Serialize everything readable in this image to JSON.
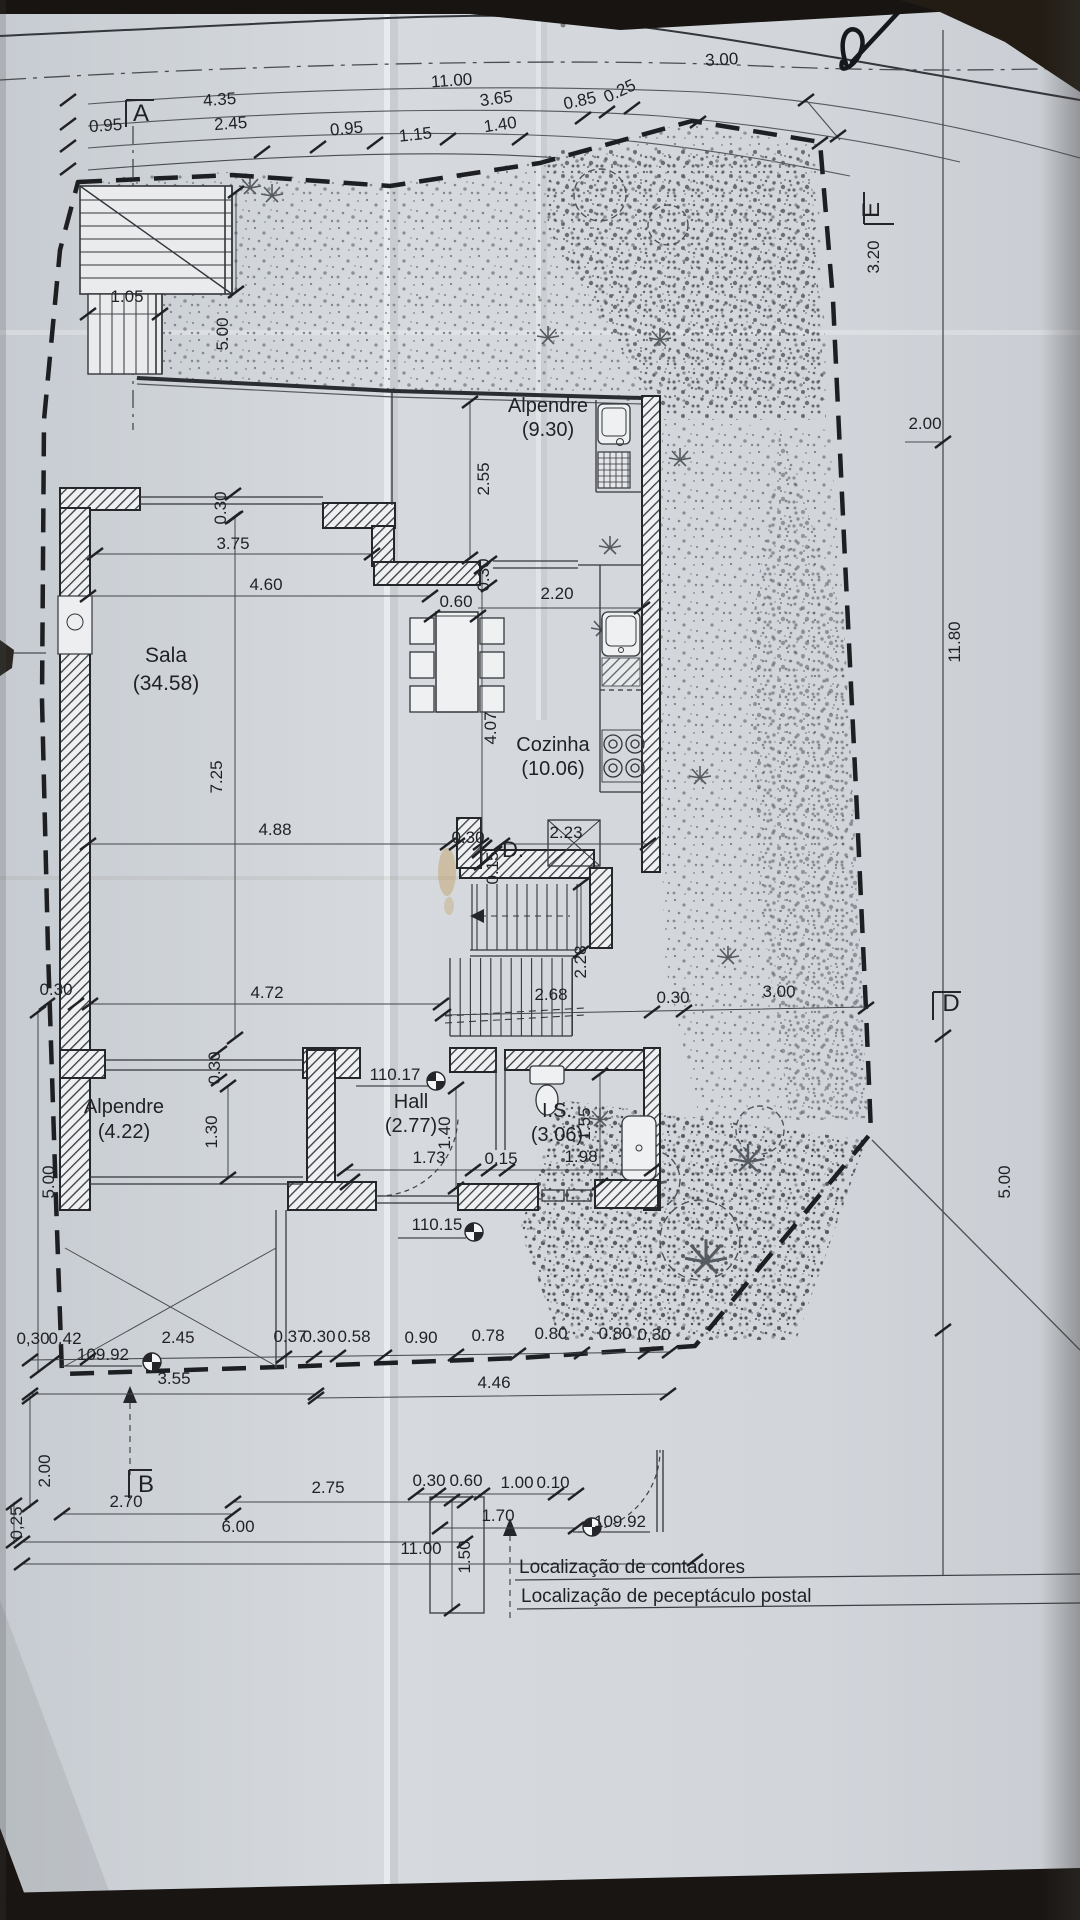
{
  "drawing": {
    "kind": "architectural ground floor plan (photographed blueprint)",
    "language": "pt",
    "paper_color": "#d2d6db",
    "ink_color": "#1f2125"
  },
  "rooms": [
    {
      "name": "Sala",
      "area": "(34.58)"
    },
    {
      "name": "Cozinha",
      "area": "(10.06)"
    },
    {
      "name": "Alpendre",
      "area": "(9.30)"
    },
    {
      "name": "Alpendre",
      "area": "(4.22)"
    },
    {
      "name": "Hall",
      "area": "(2.77)"
    },
    {
      "name": "I.S.",
      "area": "(3.06)"
    }
  ],
  "levels": [
    "110.17",
    "110.15",
    "109.92",
    "109.92"
  ],
  "section_markers": [
    "A",
    "B",
    "D",
    "D.",
    "E"
  ],
  "notes": {
    "contadores": "Localização de contadores",
    "postal": "Localização de peceptáculo postal"
  },
  "annotations": [
    {
      "t": "11.00",
      "x": 452,
      "y": 86,
      "r": -4
    },
    {
      "t": "4.35",
      "x": 220,
      "y": 105,
      "r": -4
    },
    {
      "t": "3.65",
      "x": 497,
      "y": 104,
      "r": -8
    },
    {
      "t": "3.00",
      "x": 722,
      "y": 65,
      "r": -3
    },
    {
      "t": "0.95",
      "x": 106,
      "y": 131,
      "r": -4
    },
    {
      "t": "2.45",
      "x": 231,
      "y": 129,
      "r": -4
    },
    {
      "t": "0.95",
      "x": 347,
      "y": 134,
      "r": -5
    },
    {
      "t": "1.15",
      "x": 416,
      "y": 140,
      "r": -6
    },
    {
      "t": "1.40",
      "x": 501,
      "y": 130,
      "r": -8
    },
    {
      "t": "0.85",
      "x": 581,
      "y": 106,
      "r": -12
    },
    {
      "t": "0.25",
      "x": 622,
      "y": 96,
      "r": -25
    },
    {
      "t": "A",
      "x": 141,
      "y": 121,
      "s": 24,
      "n": "section-marker-a"
    },
    {
      "t": "E",
      "x": 879,
      "y": 210,
      "r": -90,
      "s": 24,
      "n": "section-marker-e"
    },
    {
      "t": "D",
      "x": 951,
      "y": 1011,
      "s": 24,
      "n": "section-marker-d"
    },
    {
      "t": "B",
      "x": 146,
      "y": 1492,
      "s": 24,
      "n": "section-marker-b"
    },
    {
      "t": "D.",
      "x": 513,
      "y": 857,
      "s": 22,
      "n": "section-marker-d-interior"
    },
    {
      "t": "1.05",
      "x": 127,
      "y": 302
    },
    {
      "t": "5.00",
      "x": 228,
      "y": 334,
      "r": -90
    },
    {
      "t": "0.30",
      "x": 226,
      "y": 508,
      "r": -90
    },
    {
      "t": "3.75",
      "x": 233,
      "y": 549
    },
    {
      "t": "4.60",
      "x": 266,
      "y": 590
    },
    {
      "t": "7.25",
      "x": 222,
      "y": 777,
      "r": -90
    },
    {
      "t": "4.88",
      "x": 275,
      "y": 835
    },
    {
      "t": "0.30",
      "x": 56,
      "y": 995
    },
    {
      "t": "4.72",
      "x": 267,
      "y": 998
    },
    {
      "t": "2.55",
      "x": 489,
      "y": 479,
      "r": -90
    },
    {
      "t": "0.30",
      "x": 489,
      "y": 575,
      "r": -90
    },
    {
      "t": "0.60",
      "x": 456,
      "y": 607
    },
    {
      "t": "2.20",
      "x": 557,
      "y": 599
    },
    {
      "t": "4.07",
      "x": 496,
      "y": 728,
      "r": -90
    },
    {
      "t": "0.30",
      "x": 468,
      "y": 843
    },
    {
      "t": "2.23",
      "x": 566,
      "y": 838
    },
    {
      "t": "0.15",
      "x": 498,
      "y": 868,
      "r": -90
    },
    {
      "t": "2.28",
      "x": 586,
      "y": 962,
      "r": -90
    },
    {
      "t": "2.68",
      "x": 551,
      "y": 1000
    },
    {
      "t": "0.30",
      "x": 673,
      "y": 1003
    },
    {
      "t": "3.00",
      "x": 779,
      "y": 997
    },
    {
      "t": "3.20",
      "x": 879,
      "y": 257,
      "r": -90
    },
    {
      "t": "2.00",
      "x": 925,
      "y": 429
    },
    {
      "t": "11.80",
      "x": 960,
      "y": 642,
      "r": -90
    },
    {
      "t": "5.00",
      "x": 1010,
      "y": 1182,
      "r": -90
    },
    {
      "t": "5.00",
      "x": 54,
      "y": 1182,
      "r": -90
    },
    {
      "t": "0.30",
      "x": 220,
      "y": 1068,
      "r": -90
    },
    {
      "t": "110.17",
      "x": 395,
      "y": 1080,
      "n": "level-label"
    },
    {
      "t": "1.30",
      "x": 217,
      "y": 1132,
      "r": -90
    },
    {
      "t": "1.40",
      "x": 450,
      "y": 1133,
      "r": -90
    },
    {
      "t": "1.73",
      "x": 429,
      "y": 1163
    },
    {
      "t": "0.15",
      "x": 501,
      "y": 1164
    },
    {
      "t": "1.55",
      "x": 590,
      "y": 1124,
      "r": -90
    },
    {
      "t": "1.98",
      "x": 581,
      "y": 1162
    },
    {
      "t": "110.15",
      "x": 437,
      "y": 1230,
      "n": "level-label"
    },
    {
      "t": "0,30",
      "x": 33,
      "y": 1344
    },
    {
      "t": "0.42",
      "x": 65,
      "y": 1344
    },
    {
      "t": "2.45",
      "x": 178,
      "y": 1343
    },
    {
      "t": "0.37",
      "x": 290,
      "y": 1342
    },
    {
      "t": "0.30",
      "x": 319,
      "y": 1342
    },
    {
      "t": "0.58",
      "x": 354,
      "y": 1342
    },
    {
      "t": "0.90",
      "x": 421,
      "y": 1343
    },
    {
      "t": "0.78",
      "x": 488,
      "y": 1341
    },
    {
      "t": "0.80",
      "x": 551,
      "y": 1339
    },
    {
      "t": "0.80",
      "x": 615,
      "y": 1339
    },
    {
      "t": "0,30",
      "x": 654,
      "y": 1340
    },
    {
      "t": "3.55",
      "x": 174,
      "y": 1384
    },
    {
      "t": "4.46",
      "x": 494,
      "y": 1388
    },
    {
      "t": "1.50",
      "x": 470,
      "y": 1557,
      "r": -90
    },
    {
      "t": "109.92",
      "x": 620,
      "y": 1527,
      "n": "level-label"
    },
    {
      "t": "109.92",
      "x": 103,
      "y": 1360,
      "n": "level-label"
    },
    {
      "t": "2.00",
      "x": 50,
      "y": 1471,
      "r": -90
    },
    {
      "t": "2.70",
      "x": 126,
      "y": 1507
    },
    {
      "t": "0,25",
      "x": 22,
      "y": 1523,
      "r": -90
    },
    {
      "t": "6.00",
      "x": 238,
      "y": 1532
    },
    {
      "t": "2.75",
      "x": 328,
      "y": 1493
    },
    {
      "t": "0.30",
      "x": 429,
      "y": 1486
    },
    {
      "t": "0.60",
      "x": 466,
      "y": 1486
    },
    {
      "t": "1.00",
      "x": 517,
      "y": 1488
    },
    {
      "t": "0.10",
      "x": 553,
      "y": 1488
    },
    {
      "t": "1.70",
      "x": 498,
      "y": 1521
    },
    {
      "t": "11.00",
      "x": 421,
      "y": 1554
    },
    {
      "t": "Alpendre",
      "x": 548,
      "y": 412,
      "s": 20,
      "n": "room-label-alpendre-1"
    },
    {
      "t": "(9.30)",
      "x": 548,
      "y": 436,
      "s": 20,
      "n": "room-area-alpendre-1"
    },
    {
      "t": "Sala",
      "x": 166,
      "y": 662,
      "s": 21,
      "n": "room-label-sala"
    },
    {
      "t": "(34.58)",
      "x": 166,
      "y": 690,
      "s": 21,
      "n": "room-area-sala"
    },
    {
      "t": "Cozinha",
      "x": 553,
      "y": 751,
      "s": 20,
      "n": "room-label-cozinha"
    },
    {
      "t": "(10.06)",
      "x": 553,
      "y": 775,
      "s": 20,
      "n": "room-area-cozinha"
    },
    {
      "t": "Alpendre",
      "x": 124,
      "y": 1113,
      "s": 20,
      "n": "room-label-alpendre-2"
    },
    {
      "t": "(4.22)",
      "x": 124,
      "y": 1138,
      "s": 20,
      "n": "room-area-alpendre-2"
    },
    {
      "t": "Hall",
      "x": 411,
      "y": 1108,
      "s": 20,
      "n": "room-label-hall"
    },
    {
      "t": "(2.77)",
      "x": 411,
      "y": 1132,
      "s": 20,
      "n": "room-area-hall"
    },
    {
      "t": "I.S.",
      "x": 557,
      "y": 1117,
      "s": 20,
      "n": "room-label-is"
    },
    {
      "t": "(3.06)",
      "x": 557,
      "y": 1141,
      "s": 20,
      "n": "room-area-is"
    },
    {
      "t": "Localização de contadores",
      "x": 519,
      "y": 1573,
      "s": 19,
      "a": "start",
      "n": "note-contadores"
    },
    {
      "t": "Localização de peceptáculo postal",
      "x": 521,
      "y": 1602,
      "s": 19,
      "a": "start",
      "n": "note-postal"
    }
  ]
}
